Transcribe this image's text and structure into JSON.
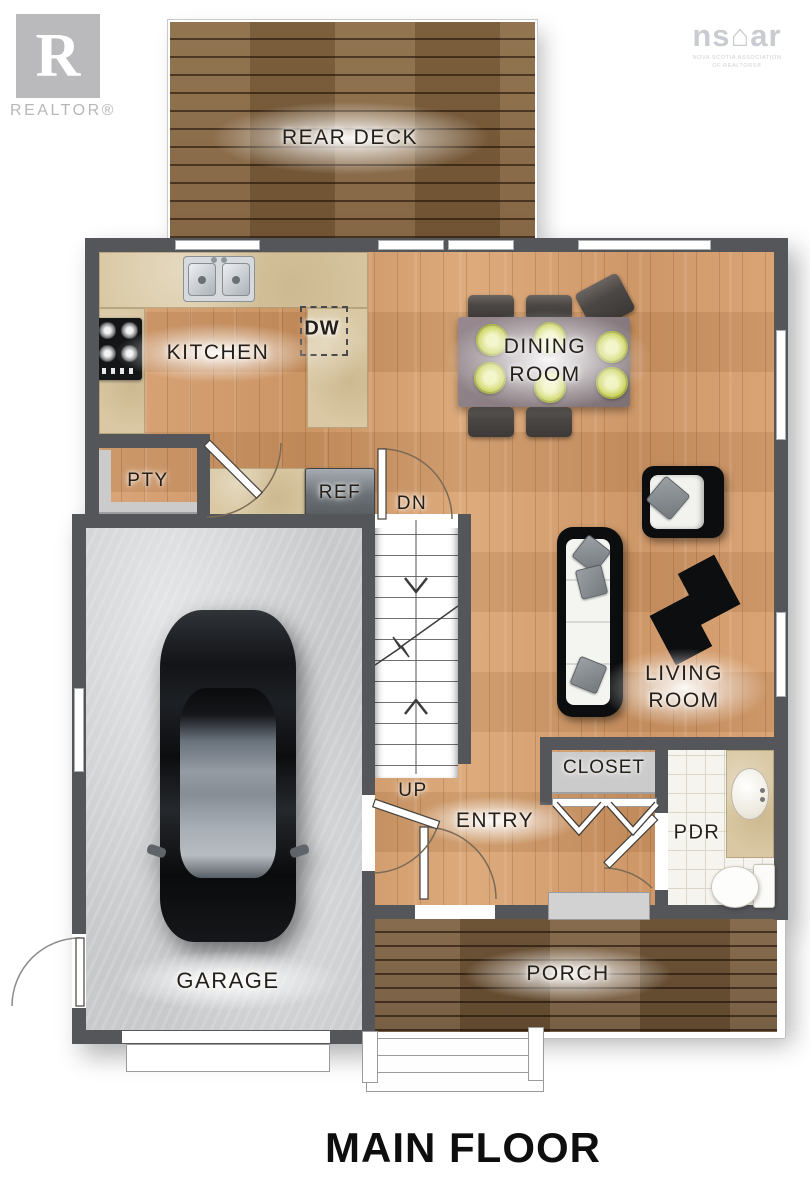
{
  "branding": {
    "realtor": {
      "monogram": "R",
      "label": "REALTOR®"
    },
    "nsar": {
      "wordmark_left": "ns",
      "house_glyph": "⌂",
      "wordmark_right": "ar",
      "subtitle_line1": "NOVA SCOTIA ASSOCIATION",
      "subtitle_line2": "OF REALTORS®"
    }
  },
  "plan": {
    "title": "MAIN FLOOR",
    "labels": {
      "rear_deck": "REAR DECK",
      "kitchen": "KITCHEN",
      "dishwasher": "DW",
      "pantry": "PTY",
      "fridge": "REF",
      "stairs_down": "DN",
      "stairs_up": "UP",
      "dining_line1": "DINING",
      "dining_line2": "ROOM",
      "living_line1": "LIVING",
      "living_line2": "ROOM",
      "entry": "ENTRY",
      "closet": "CLOSET",
      "powder_room": "PDR",
      "garage": "GARAGE",
      "porch": "PORCH"
    },
    "colors": {
      "wall": "#55565a",
      "hardwood": "#d29a6a",
      "deck-wood": "#86653f",
      "porch-wood": "#75573a",
      "counter": "#d9c8a3",
      "concrete": "#c7c9cb",
      "tile": "#f6f4ee",
      "plate": "#ccd45e",
      "label-text": "#241f19"
    }
  }
}
